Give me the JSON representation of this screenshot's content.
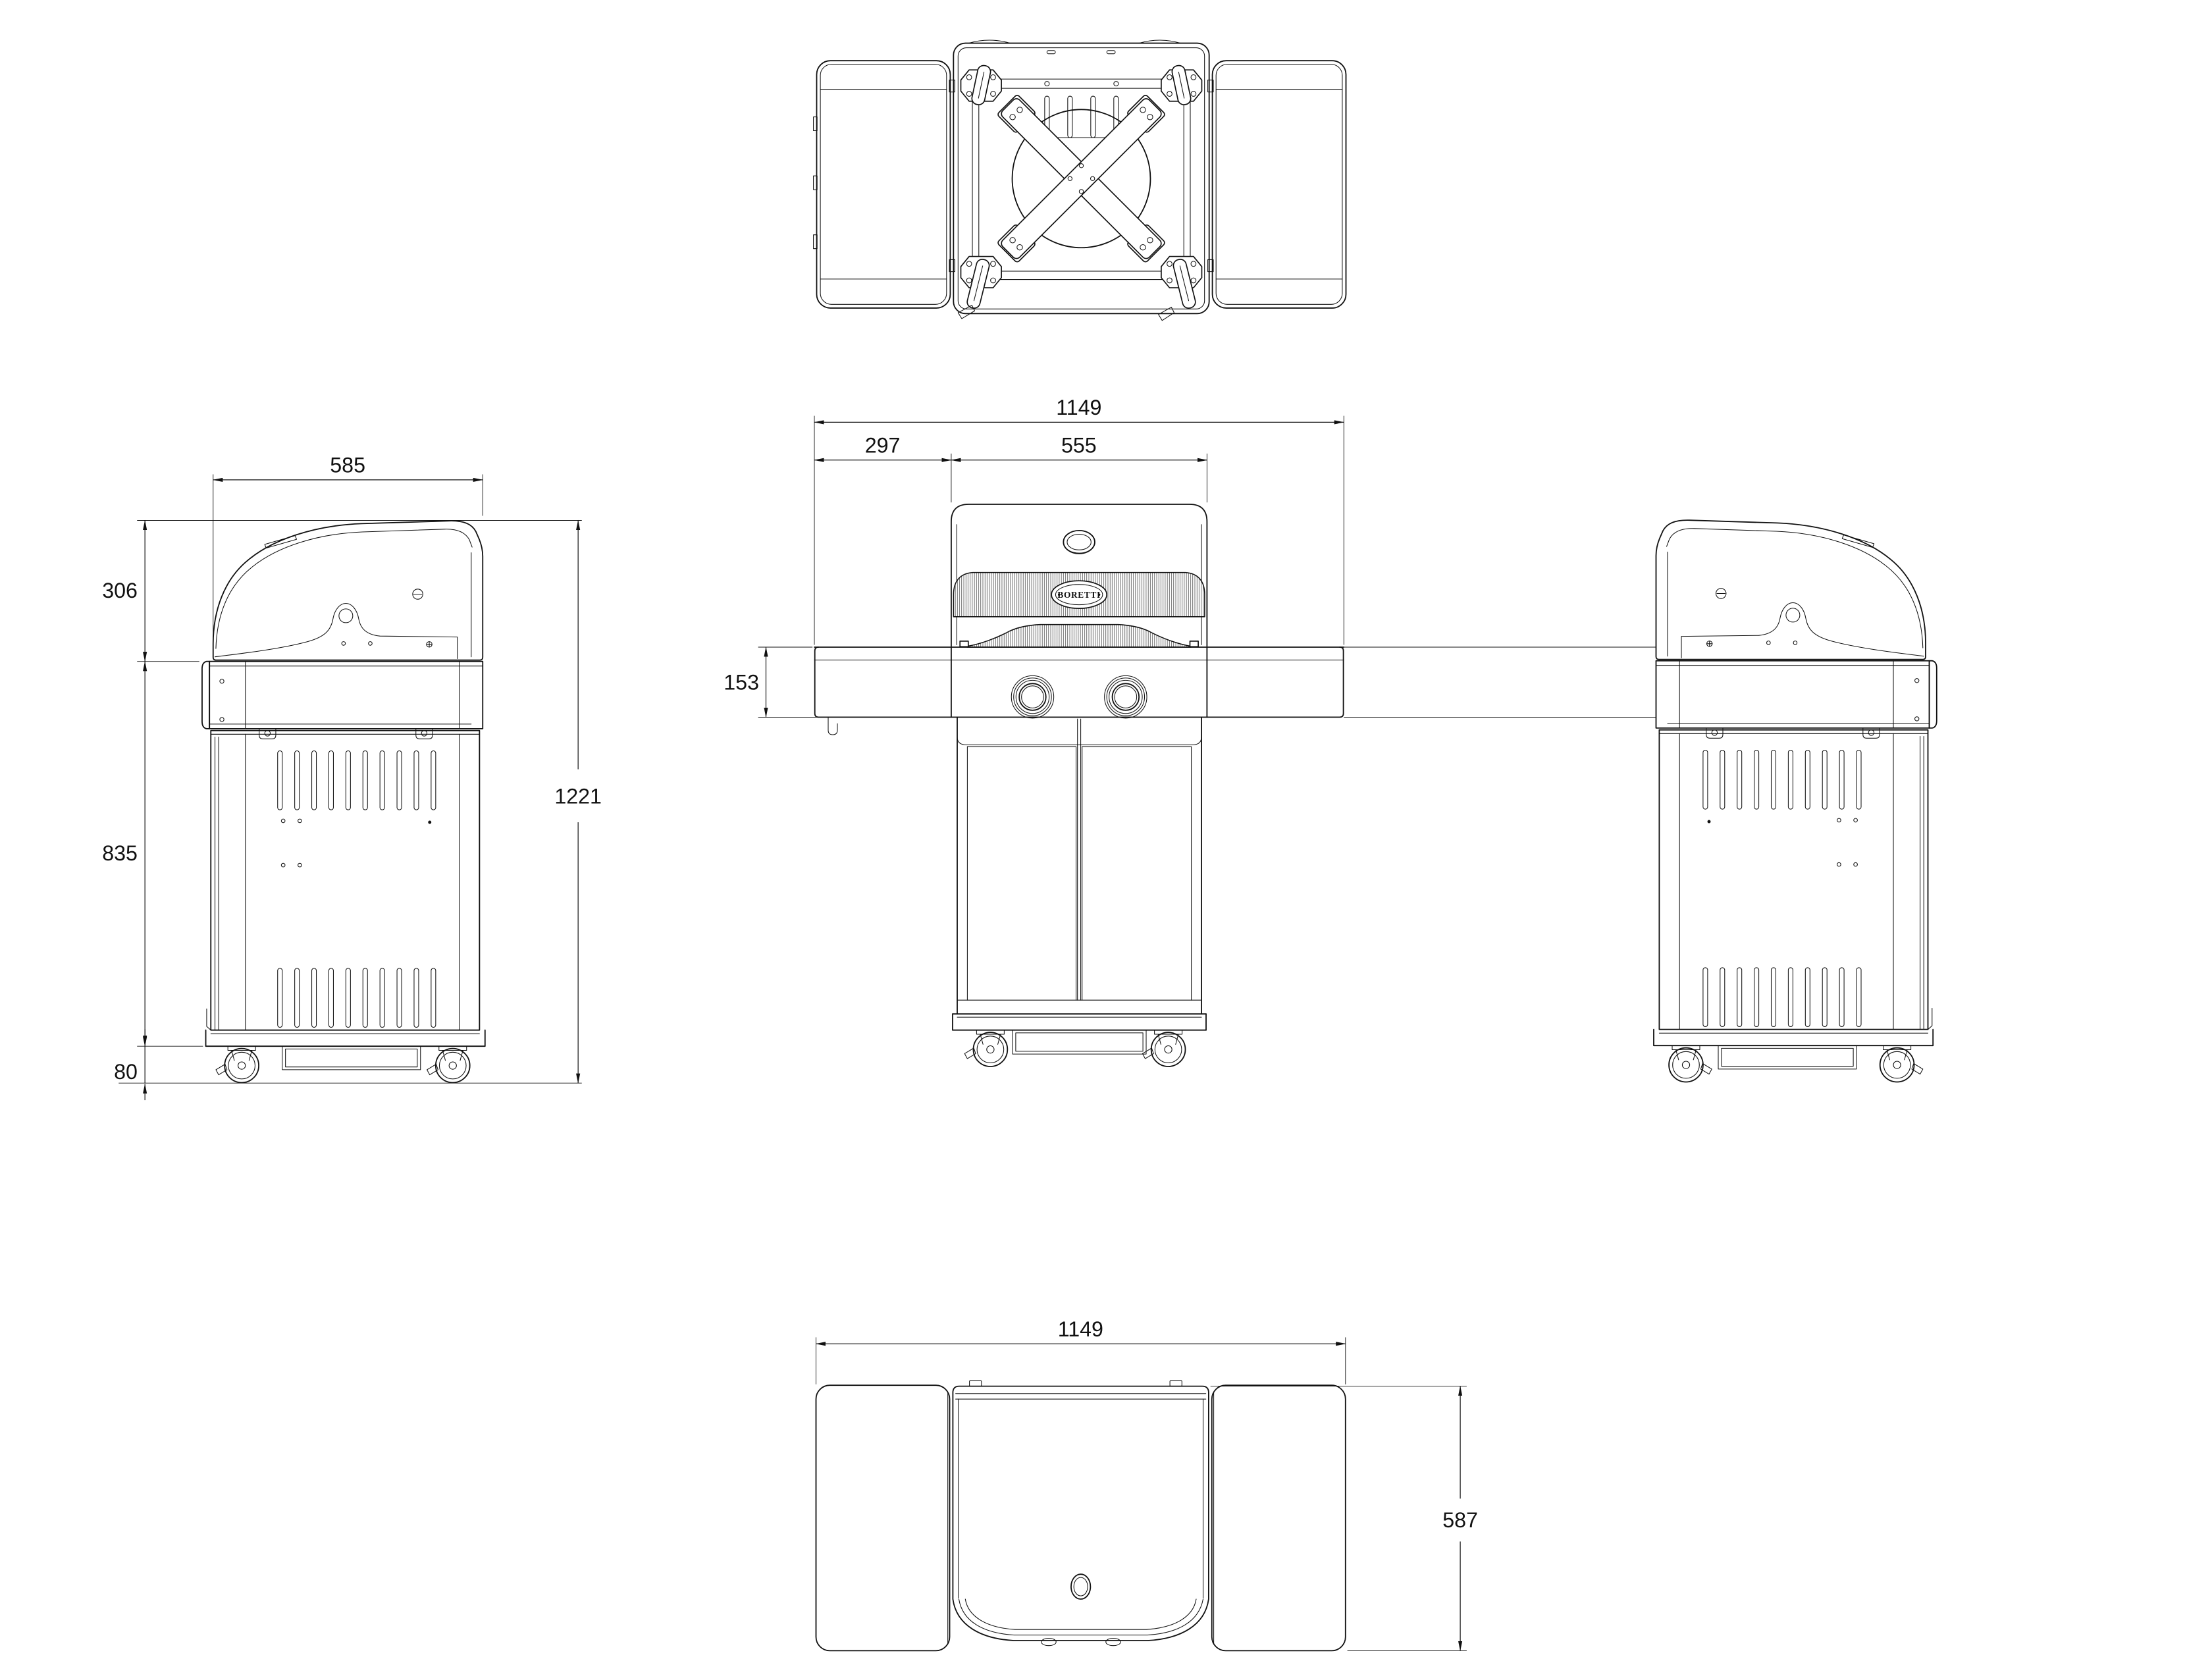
{
  "drawing": {
    "brand": "BORETTI",
    "colors": {
      "line": "#111111",
      "background": "#ffffff"
    },
    "dims": {
      "side_width": "585",
      "side_hood_height": "306",
      "side_cart_height": "835",
      "side_caster_height": "80",
      "side_total_height": "1221",
      "front_total_width": "1149",
      "front_shelf_width": "297",
      "front_body_width": "555",
      "front_shelf_height": "153",
      "plan_total_width": "1149",
      "plan_depth": "587"
    }
  }
}
